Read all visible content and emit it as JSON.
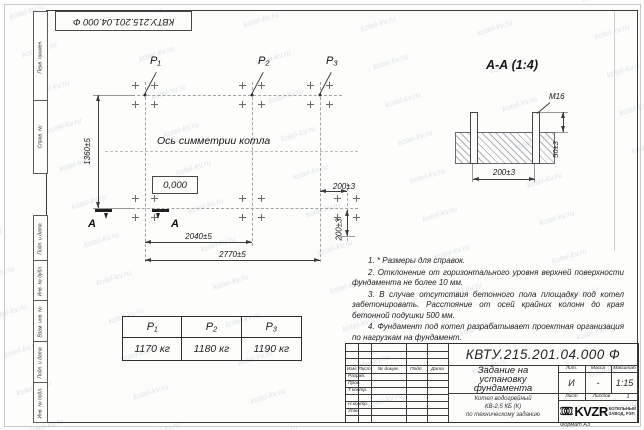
{
  "watermark": "kotel-kv.ru",
  "corner_stamp": "КВТУ.215.201.04.000 Ф",
  "frame_fields": {
    "perv": "Перв. примен.",
    "sprav": "Справ. №",
    "podp1": "Подп. и дата",
    "inv_dubl": "Инв. № дубл.",
    "vzam": "Взам. инв. №",
    "podp2": "Подп. и дата",
    "inv_podl": "Инв. № подл."
  },
  "plan": {
    "p1": "P₁",
    "p2": "P₂",
    "p3": "P₃",
    "symmetry_label": "Ось симметрии котла",
    "level": "0,000",
    "dim_height": "1360±5",
    "dim_w1": "2040±5",
    "dim_w2": "2770±5",
    "dim_offset_h": "200±3",
    "dim_offset_v": "200±3",
    "section_letter": "A"
  },
  "section_view": {
    "title": "А-А (1:4)",
    "thread": "М16",
    "dim_protrusion": "50±3",
    "dim_spacing": "200±3"
  },
  "load_table": {
    "headers": [
      "P₁",
      "P₂",
      "P₃"
    ],
    "values": [
      "1170 кг",
      "1180 кг",
      "1190 кг"
    ]
  },
  "notes": {
    "n1": "1. * Размеры для справок.",
    "n2": "2. Отклонение от горизонтального уровня верхней поверхности фундамента не более 10 мм.",
    "n3": "3. В случае отсутствия бетонного пола площадку под котел забетонировать. Расстояние от осей крайних колонн до края бетонной подушки 500 мм.",
    "n4": "4. Фундамент под котел разрабатывает проектная организация по нагрузкам на фундамент.",
    "title": "Примечания"
  },
  "title_block": {
    "doc_number": "КВТУ.215.201.04.000 Ф",
    "title_l1": "Задание на",
    "title_l2": "установку",
    "title_l3": "фундамента",
    "product_l1": "Котел водогрейный",
    "product_l2": "КВ-2,5 КБ (К)",
    "product_l3": "по техническому заданию",
    "col_izm": "Изм.",
    "col_list": "Лист",
    "col_docnum": "№ докум.",
    "col_podp": "Подп.",
    "col_data": "Дата",
    "row_razrab": "Разраб.",
    "row_prov": "Пров.",
    "row_tkontr": "Т.контр.",
    "row_nkontr": "Н.контр.",
    "row_utv": "Утв.",
    "lit_header": "Лит.",
    "mass_header": "Масса",
    "scale_header": "Масштаб",
    "lit_value": "И",
    "mass_value": "-",
    "scale_value": "1:15",
    "sheet_label": "Лист",
    "sheets_label": "Листов",
    "sheets_value": "1",
    "company": "KVZR",
    "company_sub1": "КОТЕЛЬНЫЙ",
    "company_sub2": "ЗАВОД, РЭП",
    "format": "Формат А3"
  }
}
